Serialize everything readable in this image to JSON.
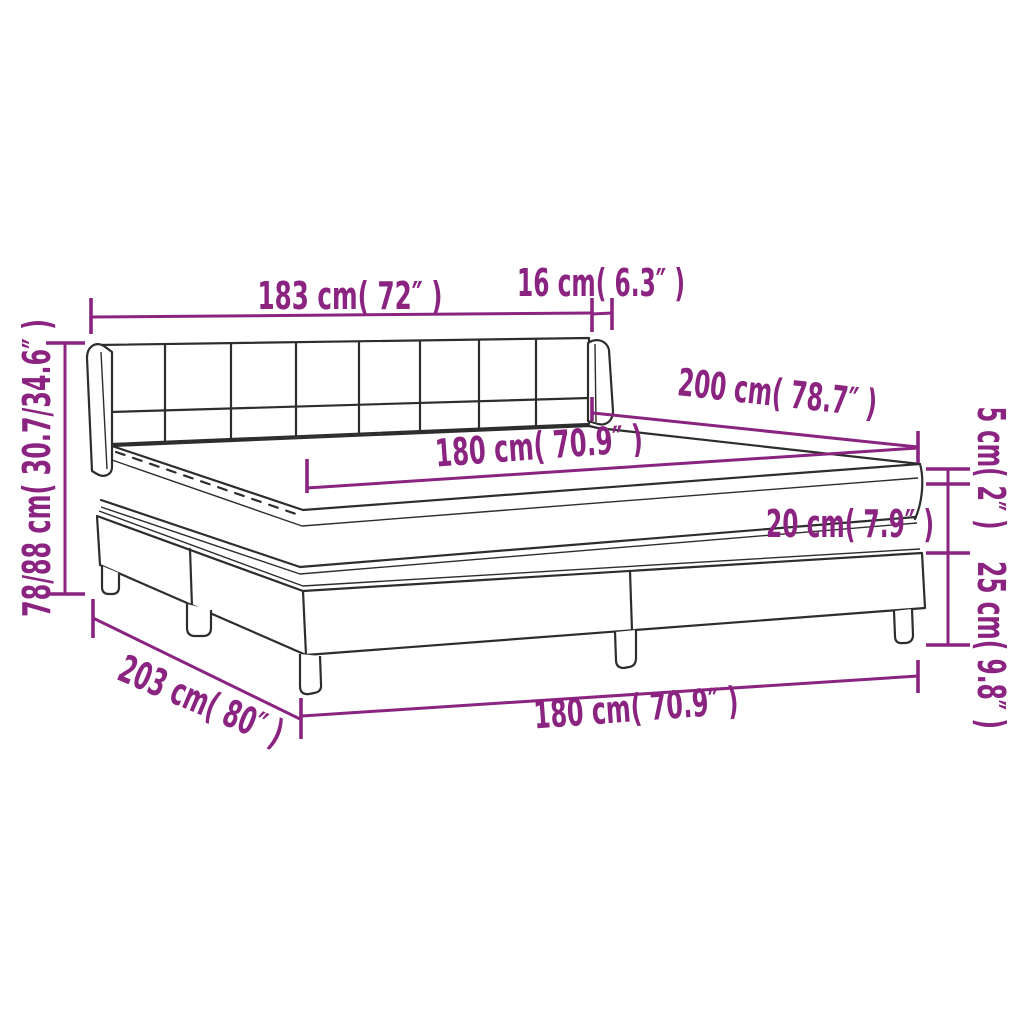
{
  "diagram": {
    "type": "product-dimension-diagram",
    "subject": "box spring bed with headboard, mattress topper and legs",
    "colors": {
      "accent": "#8A2480",
      "line": "#2D2D2D",
      "background": "#FFFFFF"
    },
    "labels": {
      "headboard_width": "183 cm( 72″ )",
      "headboard_depth": "16 cm( 6.3″ )",
      "bed_length": "200 cm( 78.7″ )",
      "mattress_width": "180 cm( 70.9″ )",
      "topper_height": "5 cm( 2″ )",
      "mattress_height": "20 cm( 7.9″ )",
      "base_height": "25 cm( 9.8″ )",
      "total_height": "78/88 cm( 30.7/34.6″ )",
      "base_length": "203 cm( 80″ )",
      "base_width": "180 cm( 70.9″ )"
    }
  }
}
